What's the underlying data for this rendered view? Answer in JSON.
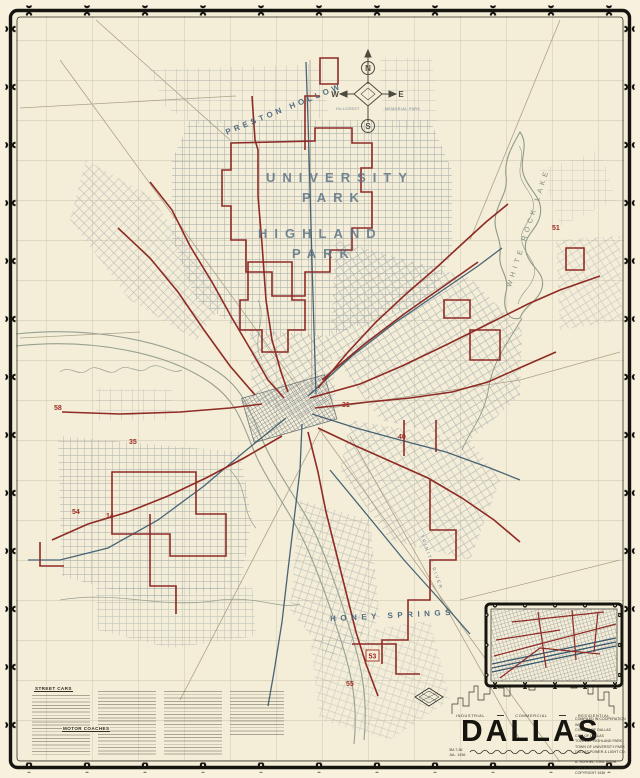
{
  "colors": {
    "paper": "#f4edd8",
    "frame_ink": "#15140e",
    "street_gray": "#98a2a6",
    "route_red": "#8e2b25",
    "route_blue": "#35566b",
    "water_green": "#96a091",
    "label_blue": "#5e7486"
  },
  "map": {
    "places": {
      "preston_hollow": "PRESTON HOLLOW",
      "university_park_1": "UNIVERSITY",
      "university_park_2": "PARK",
      "highland_park_1": "HIGHLAND",
      "highland_park_2": "PARK",
      "white_rock_lake": "WHITE ROCK LAKE",
      "honey_springs": "HONEY SPRINGS",
      "trinity_river": "TRINITY RIVER",
      "hillcrest_1": "HILLCREST",
      "hillcrest_2": "MEMORIAL PARK"
    },
    "compass": {
      "n": "N",
      "s": "S",
      "e": "E",
      "w": "W"
    },
    "route_numbers": {
      "r58": "58",
      "r35": "35",
      "r54": "54",
      "r14": "14",
      "r51": "51",
      "r31": "31",
      "r40": "40",
      "r53": "53",
      "r55": "55"
    }
  },
  "legend": {
    "street_cars_title": "STREET CARS",
    "motor_coaches_title": "MOTOR COACHES"
  },
  "title_block": {
    "title": "DALLAS",
    "zones": [
      "INDUSTRIAL",
      "COMMERCIAL",
      "RESIDENTIAL"
    ],
    "credits": [
      "COMPILED IN COOPERATION WITH",
      "COUNTY OF DALLAS",
      "CITY OF DALLAS",
      "TOWN OF HIGHLAND PARK",
      "TOWN OF UNIVERSITY PARK",
      "DALLAS POWER & LIGHT CO."
    ],
    "credits2": [
      "A. SCHOEL, CIVIL ENGR.",
      "CITY & TERRACE ADDITIONS",
      "COPYRIGHT 1936"
    ],
    "date_notes": [
      "3M-7-36",
      "JUL. 1936"
    ]
  }
}
